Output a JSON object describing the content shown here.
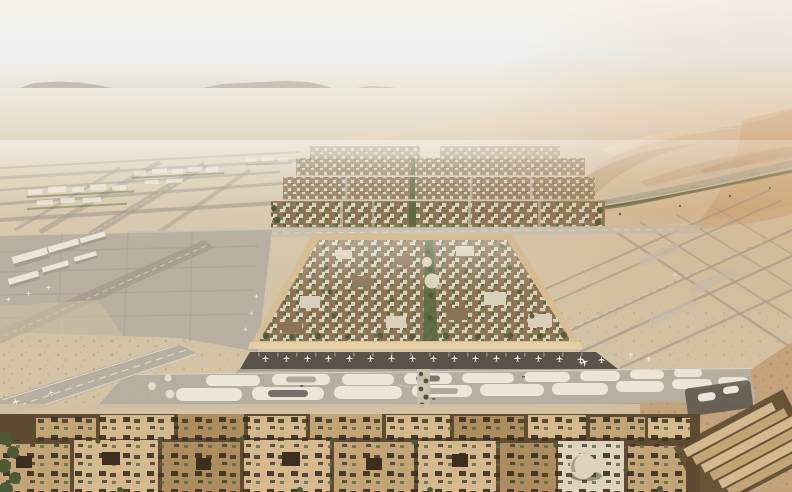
{
  "scene": {
    "title": "Aerial rendering of a vast desert airport: central walled square district flanked by runways, terminal gates with aircraft, dunes to the right and a dense low-rise city in the foreground",
    "regions": {
      "sky": "hazy pale desert sky with faint distant mesas",
      "mountains": "distant flat mesa silhouettes on the horizon",
      "dunes": "rolling sand dunes with a band of vegetation at their base",
      "midground_districts": "rows of dense city blocks with green spines receding toward the horizon",
      "left_airfield": "fan of runways and taxiways with small terminal buildings",
      "right_airfield": "crossing runway line network on sand",
      "central_district": "square walled old-town district with domes, trees and a central green spine",
      "terminal": "linear terminal strip with aircraft parked at gates",
      "taxiway_corridor": "wide taxiway corridor with pale stadium-shaped islands",
      "foreground_city": "flat-roofed courtyard blocks, a small dome and diagonal bar buildings"
    },
    "aircraft_at_gates": 17,
    "domes_visible": 3
  },
  "palette": {
    "skyTop": "#f5f2ec",
    "skyMid": "#eef0ee",
    "skyBlue": "#c9d6db",
    "horizon": "#eee6d6",
    "mountain": "#a3978a",
    "desertFar": "#e0d3bc",
    "desertMid": "#d5c5a8",
    "sand": "#d2c1a2",
    "sandShadow": "#b5a17d",
    "duneLight": "#e4d2b4",
    "duneMid": "#d6c09e",
    "duneShadow": "#b3926c",
    "duneOrange": "#c78e58",
    "duneDark": "#8f6f4c",
    "vegetation": "#75754d",
    "vegetationDark": "#4d5a35",
    "pavement": "#b6ae9f",
    "pavementDark": "#a49c8d",
    "pavementLight": "#c8c1b1",
    "marking": "#ece6d9",
    "wallTan": "#d7bd92",
    "wallLight": "#e4cfa6",
    "cityBase": "#96815f",
    "cityBrown": "#8a7455",
    "cityCream": "#d9d0bc",
    "cityGreen": "#5d6b41",
    "terminalDark": "#59534b",
    "apron": "#a8a093",
    "aircraft": "#f3f0e9",
    "roofLight": "#d3b98d",
    "roofMid": "#c2a577",
    "roofDark": "#ab8d60",
    "courtyard": "#3c2f1f",
    "gapShadow": "#5f4b31",
    "dirt": "#c3a37b",
    "domeFill": "#dcd2bd"
  }
}
